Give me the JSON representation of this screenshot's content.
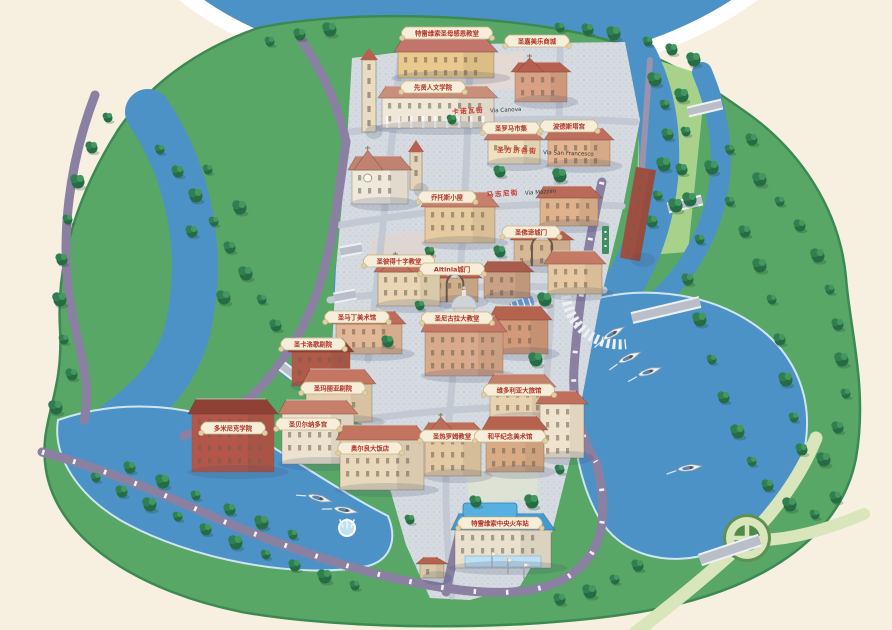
{
  "map": {
    "name": "illustrated-italian-town-tourist-map",
    "landmarks": [
      {
        "label": "特雷维索圣母感恩教堂"
      },
      {
        "label": "圣嘉美乐商城"
      },
      {
        "label": "先贤人文学院"
      },
      {
        "label": "圣罗马市集"
      },
      {
        "label": "波德斯塔宫"
      },
      {
        "label": "乔托斯小屋"
      },
      {
        "label": "圣佛谛城门"
      },
      {
        "label": "圣彼得十字教堂"
      },
      {
        "label": "Altinia城门"
      },
      {
        "label": "圣马丁美术馆"
      },
      {
        "label": "圣尼古拉大教堂"
      },
      {
        "label": "圣卡洛歌剧院"
      },
      {
        "label": "圣玛丽亚剧院"
      },
      {
        "label": "维多利亚大旅馆"
      },
      {
        "label": "多米尼克学院"
      },
      {
        "label": "圣贝尔纳多宫"
      },
      {
        "label": "奥尔良大饭店"
      },
      {
        "label": "圣热罗姆教堂"
      },
      {
        "label": "和平纪念美术馆"
      },
      {
        "label": "特雷维索中央火车站"
      }
    ],
    "streets": [
      {
        "zh": "卡诺瓦街",
        "it": "Via Canova"
      },
      {
        "zh": "圣方济各街",
        "it": "Via San Francesco"
      },
      {
        "zh": "马志尼街",
        "it": "Via Mazzini"
      }
    ],
    "features": {
      "rowboats": 6,
      "fountain": 1,
      "roundabout": 1
    },
    "colors": {
      "background": "#f7f0e1",
      "water": "#4d92c7",
      "island_green": "#58a766",
      "tree_green": "#2f7f50",
      "road_purple": "#8a80a2",
      "road_light": "#d9e6bb",
      "town_paving": "#d6dbe1",
      "roof_red": "#c4766a",
      "banner_cream": "#f6eed9",
      "banner_text_red": "#b03328",
      "station_roof_blue": "#3f9bd4"
    }
  }
}
